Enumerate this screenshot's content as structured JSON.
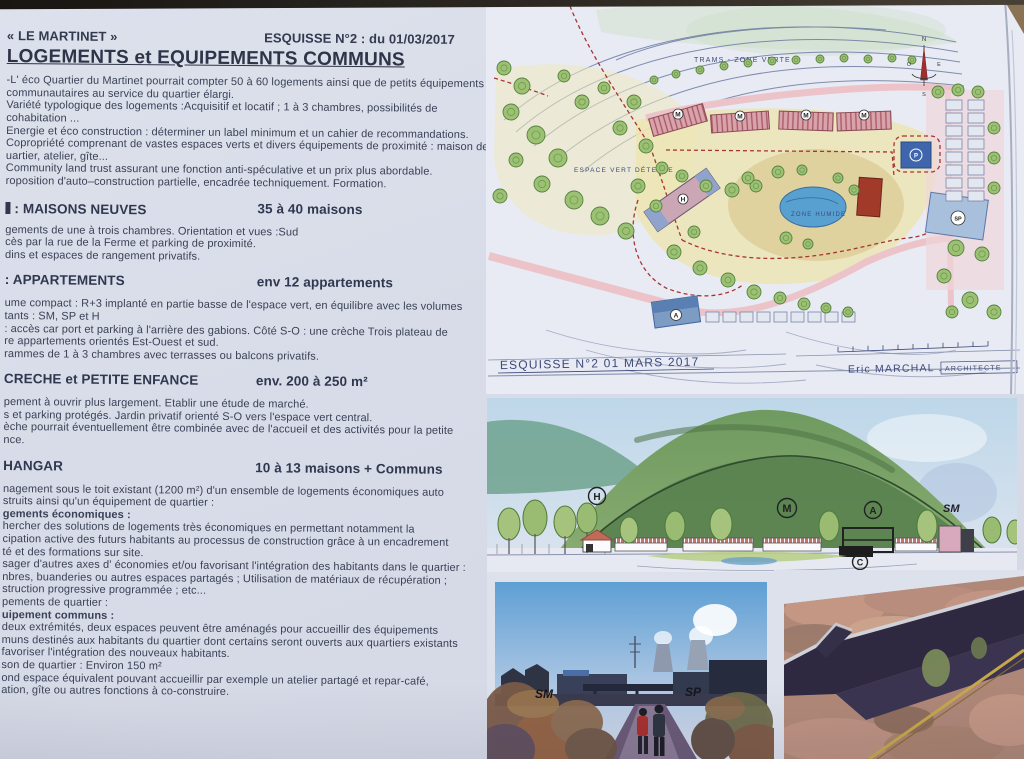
{
  "header": {
    "title_left": "« LE MARTINET »",
    "title_right": "ESQUISSE N°2 : du 01/03/2017",
    "main_heading": "LOGEMENTS et EQUIPEMENTS COMMUNS"
  },
  "intro_lines": [
    "-L' éco Quartier du Martinet pourrait compter 50 à 60 logements ainsi que de petits équipements",
    "communautaires au service du quartier élargi.",
    "Variété typologique des logements :Acquisitif et locatif ; 1 à 3 chambres, possibilités de",
    "cohabitation ...",
    "Energie et éco construction : déterminer un label minimum et un cahier de recommandations.",
    "Copropriété comprenant de vastes espaces verts et divers équipements de proximité : maison de",
    "uartier, atelier, gîte...",
    "Community land trust  assurant une fonction anti-spéculative et un prix plus abordable.",
    "roposition d'auto–construction partielle, encadrée techniquement. Formation."
  ],
  "sections": [
    {
      "id": "maisons-neuves",
      "clip": true,
      "title": ":  MAISONS NEUVES",
      "badge": "35 à 40 maisons",
      "lines": [
        {
          "t": "gements de une à trois chambres. Orientation et vues :Sud",
          "b": false
        },
        {
          "t": "cès par la rue de la Ferme et parking de proximité.",
          "b": false
        },
        {
          "t": "dins et espaces de rangement privatifs.",
          "b": false
        }
      ]
    },
    {
      "id": "appartements",
      "clip": false,
      "title": ":   APPARTEMENTS",
      "badge": "env 12 appartements",
      "lines": [
        {
          "t": "ume compact :  R+3 implanté en partie basse de l'espace vert, en équilibre avec les volumes",
          "b": false
        },
        {
          "t": "tants : SM, SP et H",
          "b": false
        },
        {
          "t": ": accès car port et parking à l'arrière des gabions. Côté S-O  : une crèche Trois plateau de",
          "b": false
        },
        {
          "t": "re appartements orientés Est-Ouest et sud.",
          "b": false
        },
        {
          "t": "rammes de 1 à 3 chambres avec terrasses ou balcons privatifs.",
          "b": false
        }
      ]
    },
    {
      "id": "creche",
      "clip": false,
      "title": "CRECHE et PETITE ENFANCE",
      "badge": "env. 200 à 250 m²",
      "lines": [
        {
          "t": "pement à ouvrir plus largement. Etablir une étude de marché.",
          "b": false
        },
        {
          "t": "s et parking protégés. Jardin privatif orienté S-O vers l'espace vert central.",
          "b": false
        },
        {
          "t": "èche pourrait éventuellement être combinée avec de l'accueil et des activités pour la petite",
          "b": false
        },
        {
          "t": "nce.",
          "b": false
        }
      ]
    },
    {
      "id": "hangar",
      "clip": false,
      "title": "HANGAR",
      "badge": "10 à 13 maisons + Communs",
      "lines": [
        {
          "t": "nagement sous le toit existant (1200 m²) d'un ensemble de logements économiques auto",
          "b": false
        },
        {
          "t": "struits ainsi qu'un équipement de quartier :",
          "b": false
        },
        {
          "t": "gements économiques :",
          "b": true
        },
        {
          "t": "hercher des solutions de logements très économiques en permettant notamment la",
          "b": false
        },
        {
          "t": "cipation active des futurs habitants au processus de construction grâce à un encadrement",
          "b": false
        },
        {
          "t": "té  et des formations sur site.",
          "b": false
        },
        {
          "t": "sager d'autres axes d' économies et/ou favorisant l'intégration des habitants dans le quartier :",
          "b": false
        },
        {
          "t": "nbres, buanderies ou autres espaces partagés ; Utilisation de matériaux de récupération ;",
          "b": false
        },
        {
          "t": "struction progressive programmée ; etc...",
          "b": false
        },
        {
          "t": "pements de quartier :",
          "b": false
        },
        {
          "t": "uipement communs :",
          "b": true
        },
        {
          "t": "deux extrémités, deux espaces peuvent être aménagés pour accueillir des équipements",
          "b": false
        },
        {
          "t": "muns destinés aux habitants du quartier dont certains seront ouverts aux quartiers existants",
          "b": false
        },
        {
          "t": "favoriser l'intégration des nouveaux habitants.",
          "b": false
        },
        {
          "t": "son de quartier : Environ 150 m²",
          "b": false
        },
        {
          "t": "ond espace équivalent pouvant accueillir par exemple un atelier partagé et repar-café,",
          "b": false
        },
        {
          "t": "ation, gîte ou autres fonctions à co-construire.",
          "b": false
        }
      ]
    }
  ],
  "plan": {
    "label_trams": "TRAMS - ZONE VERTE",
    "label_espace": "ESPACE VERT DÉTENTE",
    "label_zone_humide": "ZONE HUMIDE",
    "caption": "ESQUISSE  N°2   01 MARS  2017",
    "architect": "Eric MARCHAL .",
    "architect_title": "ARCHITECTE",
    "compass": {
      "n": "N",
      "s": "S",
      "e": "E",
      "o": "O"
    },
    "letters": {
      "m1": "M",
      "m2": "M",
      "m3": "M",
      "m4": "M",
      "h": "H",
      "a": "A",
      "sp": "SP",
      "p": "P"
    }
  },
  "elevation": {
    "letters": {
      "h": "H",
      "m": "M",
      "a": "A",
      "c": "C"
    },
    "label_sm": "SM"
  },
  "photos": {
    "left": {
      "annotation_sm": "SM",
      "annotation_sp": "SP"
    }
  },
  "colors": {
    "paper": "#dde1ec",
    "ink": "#3a4156",
    "plan_pink_building": "#d9a3ac",
    "plan_tree": "#9cc173",
    "plan_pond": "#58a0d0",
    "plan_road": "#ecc3c9",
    "plan_red_dash": "#a83434",
    "hill_green": "#7aa468",
    "table_brown": "#8a7254"
  }
}
